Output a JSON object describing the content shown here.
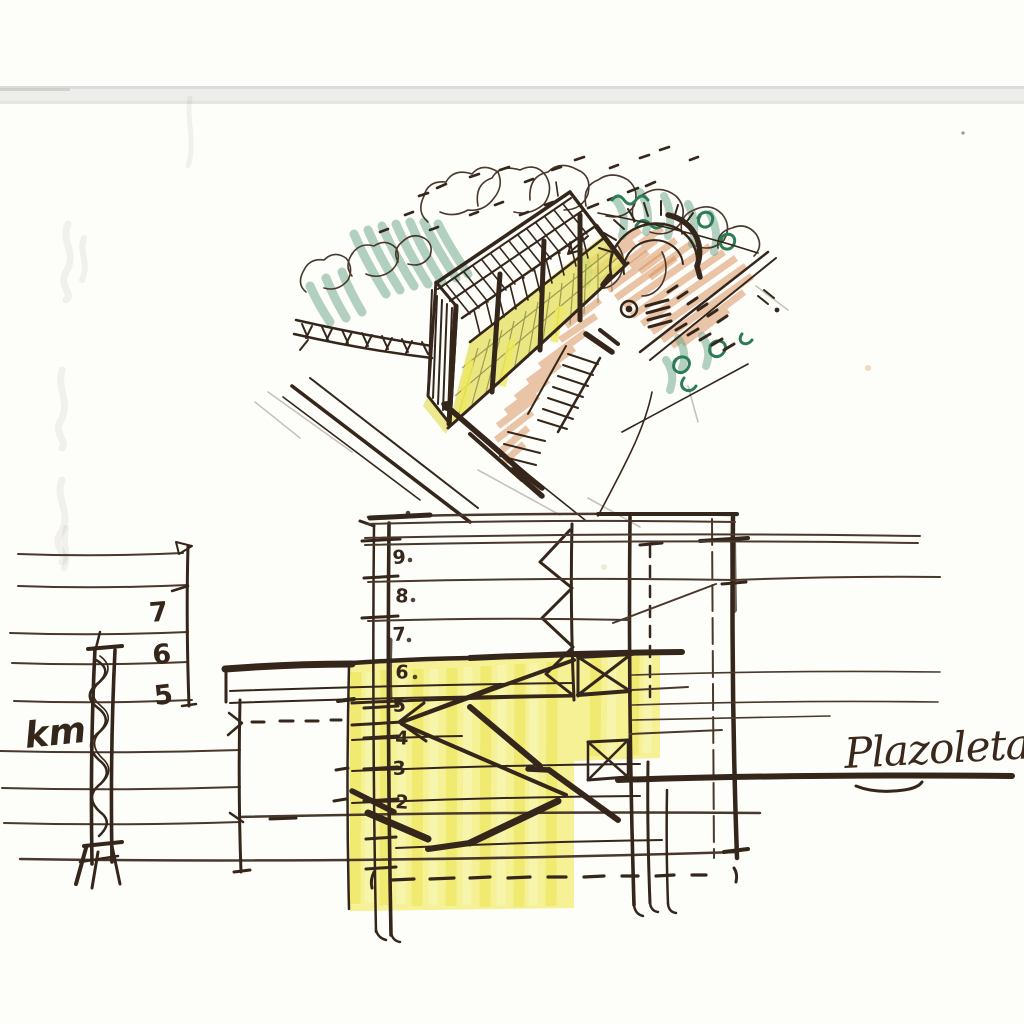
{
  "labels": {
    "site_note": "km",
    "plaza_note": "Plazoleta"
  },
  "section": {
    "left_level_labels": [
      "7",
      "6",
      "5"
    ],
    "grid_level_labels": [
      "9",
      "8",
      "7",
      "6",
      "5",
      "4",
      "3",
      "2"
    ]
  },
  "colors": {
    "pen": "#35261b",
    "pen_light": "#4a382c",
    "pencil_gray": "#a8a39a",
    "green_pen": "#2e7c55",
    "green_crayon": "#6aa487",
    "orange_crayon": "#d6874f",
    "glazing_yellow": "#e4e060",
    "highlight_yellow": "#f1ec6c",
    "paper": "#fdfdfa",
    "scan_band": "#ededeb"
  }
}
